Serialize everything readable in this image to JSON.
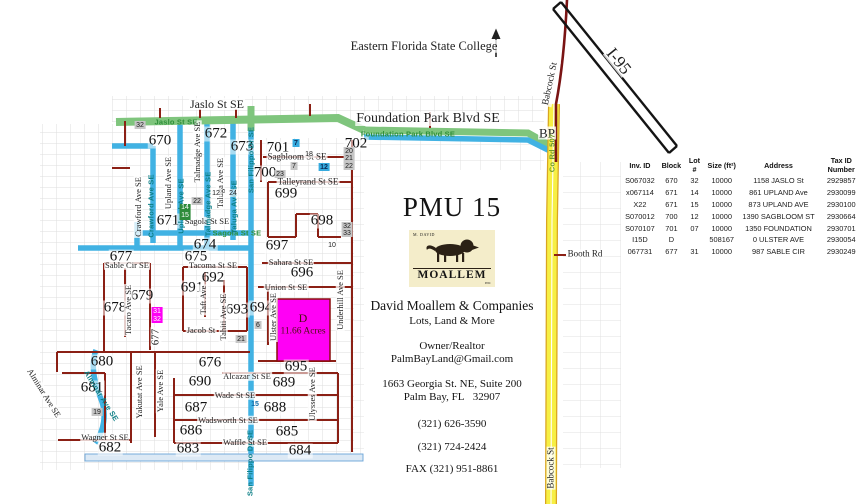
{
  "colors": {
    "road_red": "#8b2015",
    "road_blue": "#41b2e3",
    "road_green": "#7fc57d",
    "babcock_yellow": "#f7ef44",
    "parcel_magenta": "#ff00f5",
    "logo_bg": "#f4edca"
  },
  "panel": {
    "title": "PMU 15",
    "logo": {
      "top": "M. DAVID",
      "main": "MOALLEM",
      "sub": "INC"
    },
    "company": "David Moallem & Companies",
    "tagline": "Lots, Land & More",
    "role": "Owner/Realtor",
    "email": "PalmBayLand@Gmail.com",
    "address1": "1663 Georgia St. NE, Suite 200",
    "address2": "Palm Bay, FL   32907",
    "phone1": "(321) 626-3590",
    "phone2": "(321) 724-2424",
    "fax": "FAX (321) 951-8861"
  },
  "table": {
    "headers": [
      "Inv. ID",
      "Block",
      "Lot #",
      "Size (ft²)",
      "Address",
      "Tax ID Number"
    ],
    "rows": [
      [
        "S067032",
        "670",
        "32",
        "10000",
        "1158 JASLO St",
        "2929857"
      ],
      [
        "x067114",
        "671",
        "14",
        "10000",
        "861 UPLAND Ave",
        "2930099"
      ],
      [
        "X22",
        "671",
        "15",
        "10000",
        "873 UPLAND AVE",
        "2930100"
      ],
      [
        "S070012",
        "700",
        "12",
        "10000",
        "1390 SAGBLOOM ST",
        "2930664"
      ],
      [
        "S070107",
        "701",
        "07",
        "10000",
        "1350 FOUNDATION",
        "2930701"
      ],
      [
        "I15D",
        "D",
        "",
        "508167",
        "0 ULSTER AVE",
        "2930054"
      ],
      [
        "067731",
        "677",
        "31",
        "10000",
        "987 SABLE CIR",
        "2930249"
      ]
    ]
  },
  "map": {
    "blocks": [
      [
        "670",
        160,
        141
      ],
      [
        "671",
        168,
        221
      ],
      [
        "672",
        216,
        134
      ],
      [
        "673",
        242,
        147
      ],
      [
        "674",
        205,
        245
      ],
      [
        "675",
        196,
        257
      ],
      [
        "676",
        210,
        363
      ],
      [
        "677",
        121,
        257
      ],
      [
        "678",
        115,
        308
      ],
      [
        "679",
        142,
        296
      ],
      [
        "680",
        102,
        362
      ],
      [
        "681",
        92,
        388
      ],
      [
        "682",
        110,
        448
      ],
      [
        "683",
        188,
        449
      ],
      [
        "684",
        300,
        451
      ],
      [
        "685",
        287,
        432
      ],
      [
        "686",
        191,
        431
      ],
      [
        "687",
        196,
        408
      ],
      [
        "688",
        275,
        408
      ],
      [
        "689",
        284,
        383
      ],
      [
        "690",
        200,
        382
      ],
      [
        "691",
        192,
        288
      ],
      [
        "692",
        213,
        278
      ],
      [
        "693",
        237,
        310
      ],
      [
        "694",
        261,
        308
      ],
      [
        "695",
        296,
        367
      ],
      [
        "696",
        302,
        273
      ],
      [
        "697",
        277,
        246
      ],
      [
        "698",
        322,
        221
      ],
      [
        "699",
        286,
        194
      ],
      [
        "700",
        265,
        173
      ],
      [
        "701",
        278,
        148
      ],
      [
        "702",
        356,
        144
      ]
    ],
    "streets_h": [
      [
        "Jaslo St SE",
        217,
        104,
        12
      ],
      [
        "Foundation Park Blvd SE",
        428,
        119,
        14
      ],
      [
        "Sagbloom St SE",
        297,
        157,
        9
      ],
      [
        "Talleyrand St SE",
        308,
        182,
        9
      ],
      [
        "Sahara St SE",
        291,
        262,
        8.5
      ],
      [
        "Union St SE",
        286,
        287,
        8.5
      ],
      [
        "Sagola St SE",
        207,
        221,
        8.5
      ],
      [
        "Tacoma St SE",
        213,
        265,
        8.5
      ],
      [
        "Sable Cir SE",
        127,
        265,
        8.5
      ],
      [
        "Jacob St",
        201,
        330,
        8.5
      ],
      [
        "Alcazar St SE",
        247,
        376,
        8.5
      ],
      [
        "Wade St SE",
        235,
        395,
        8.5
      ],
      [
        "Wadsworth St SE",
        228,
        420,
        8.5
      ],
      [
        "Waffle St SE",
        245,
        442,
        8.5
      ],
      [
        "Wagner St SE",
        105,
        437,
        8.5
      ],
      [
        "Booth Rd",
        585,
        254,
        9
      ],
      [
        "BP",
        547,
        133,
        13
      ],
      [
        "Eastern Florida State College",
        424,
        46,
        12.5
      ]
    ],
    "streets_v": [
      [
        "Crawford Ave SE",
        138,
        207,
        8.5,
        -90
      ],
      [
        "Upland Ave SE",
        168,
        183,
        8.5,
        -90
      ],
      [
        "Talmadge Ave SE",
        197,
        152,
        8.5,
        -90
      ],
      [
        "Taluga Ave SE",
        220,
        183,
        8.5,
        -90
      ],
      [
        "Tacaro Ave SE",
        128,
        310,
        8.5,
        -90
      ],
      [
        "Taft Ave",
        203,
        300,
        8.5,
        -90
      ],
      [
        "Tahiti Ave SE",
        223,
        317,
        8.5,
        -90
      ],
      [
        "Ulster Ave SE",
        273,
        317,
        8.5,
        -90
      ],
      [
        "Underhill Ave SE",
        340,
        300,
        8.5,
        -90
      ],
      [
        "Ulysses Ave SE",
        312,
        394,
        8.5,
        -90
      ],
      [
        "Yakutat Ave SE",
        139,
        392,
        8.5,
        -90
      ],
      [
        "Yale Ave SE",
        160,
        391,
        8.5,
        -90
      ],
      [
        "677",
        156,
        337,
        11,
        -90
      ],
      [
        "Babcock St",
        551,
        84,
        9.5,
        -78
      ],
      [
        "Babcock St",
        551,
        468,
        9,
        -90
      ],
      [
        "Alminar Ave SE",
        44,
        393,
        8.5,
        58
      ],
      [
        "I-95",
        619,
        61,
        17,
        51
      ]
    ],
    "road_texts": [
      [
        "Jaslo St SE",
        176,
        122,
        0,
        "g"
      ],
      [
        "Foundation Park Blvd SE",
        408,
        134,
        0,
        "g"
      ],
      [
        "Sagola St SE",
        237,
        233,
        0,
        "g"
      ],
      [
        "Crawford Ave SE",
        151,
        206,
        -90,
        "t"
      ],
      [
        "Upland Ave SE",
        181,
        206,
        -90,
        "t"
      ],
      [
        "Talmadge Ave SE",
        208,
        204,
        -90,
        "t"
      ],
      [
        "Taluga Ave SE",
        234,
        207,
        -90,
        "t"
      ],
      [
        "San Filippo Dr SE",
        251,
        160,
        -90,
        "t"
      ],
      [
        "San Filippo Dr SE",
        250,
        463,
        -90,
        "t"
      ],
      [
        "Co Rd 507",
        552,
        153,
        -90,
        "y"
      ],
      [
        "Alminar Ave SE",
        101,
        396,
        58,
        "t"
      ]
    ],
    "markers": [
      [
        "32",
        140,
        125,
        "gray"
      ],
      [
        "22",
        197,
        201,
        "gray"
      ],
      [
        "7",
        294,
        166,
        "gray"
      ],
      [
        "23",
        280,
        174,
        "gray"
      ],
      [
        "20",
        349,
        151,
        "gray"
      ],
      [
        "21",
        349,
        158.5,
        "gray"
      ],
      [
        "22",
        349,
        166,
        "gray"
      ],
      [
        "32",
        347,
        226,
        "gray"
      ],
      [
        "33",
        347,
        233,
        "gray"
      ],
      [
        "21",
        241,
        339,
        "gray"
      ],
      [
        "6",
        258,
        325,
        "gray"
      ],
      [
        "19",
        97,
        412,
        "gray"
      ],
      [
        "18",
        309,
        154,
        "plain"
      ],
      [
        "12",
        216,
        193,
        "plain"
      ],
      [
        "24",
        233,
        193,
        "plain"
      ],
      [
        "10",
        332,
        245,
        "plain"
      ],
      [
        "14",
        185,
        207.5,
        "green"
      ],
      [
        "15",
        185,
        215.5,
        "green"
      ],
      [
        "7",
        296,
        143,
        "blue"
      ],
      [
        "12",
        324,
        167,
        "blue"
      ],
      [
        "31",
        157,
        311,
        "magenta"
      ],
      [
        "32",
        157,
        319,
        "magenta"
      ],
      [
        "15",
        255,
        404,
        "bluetext"
      ]
    ],
    "parcel": {
      "letter": "D",
      "area": "11.66 Acres"
    }
  }
}
